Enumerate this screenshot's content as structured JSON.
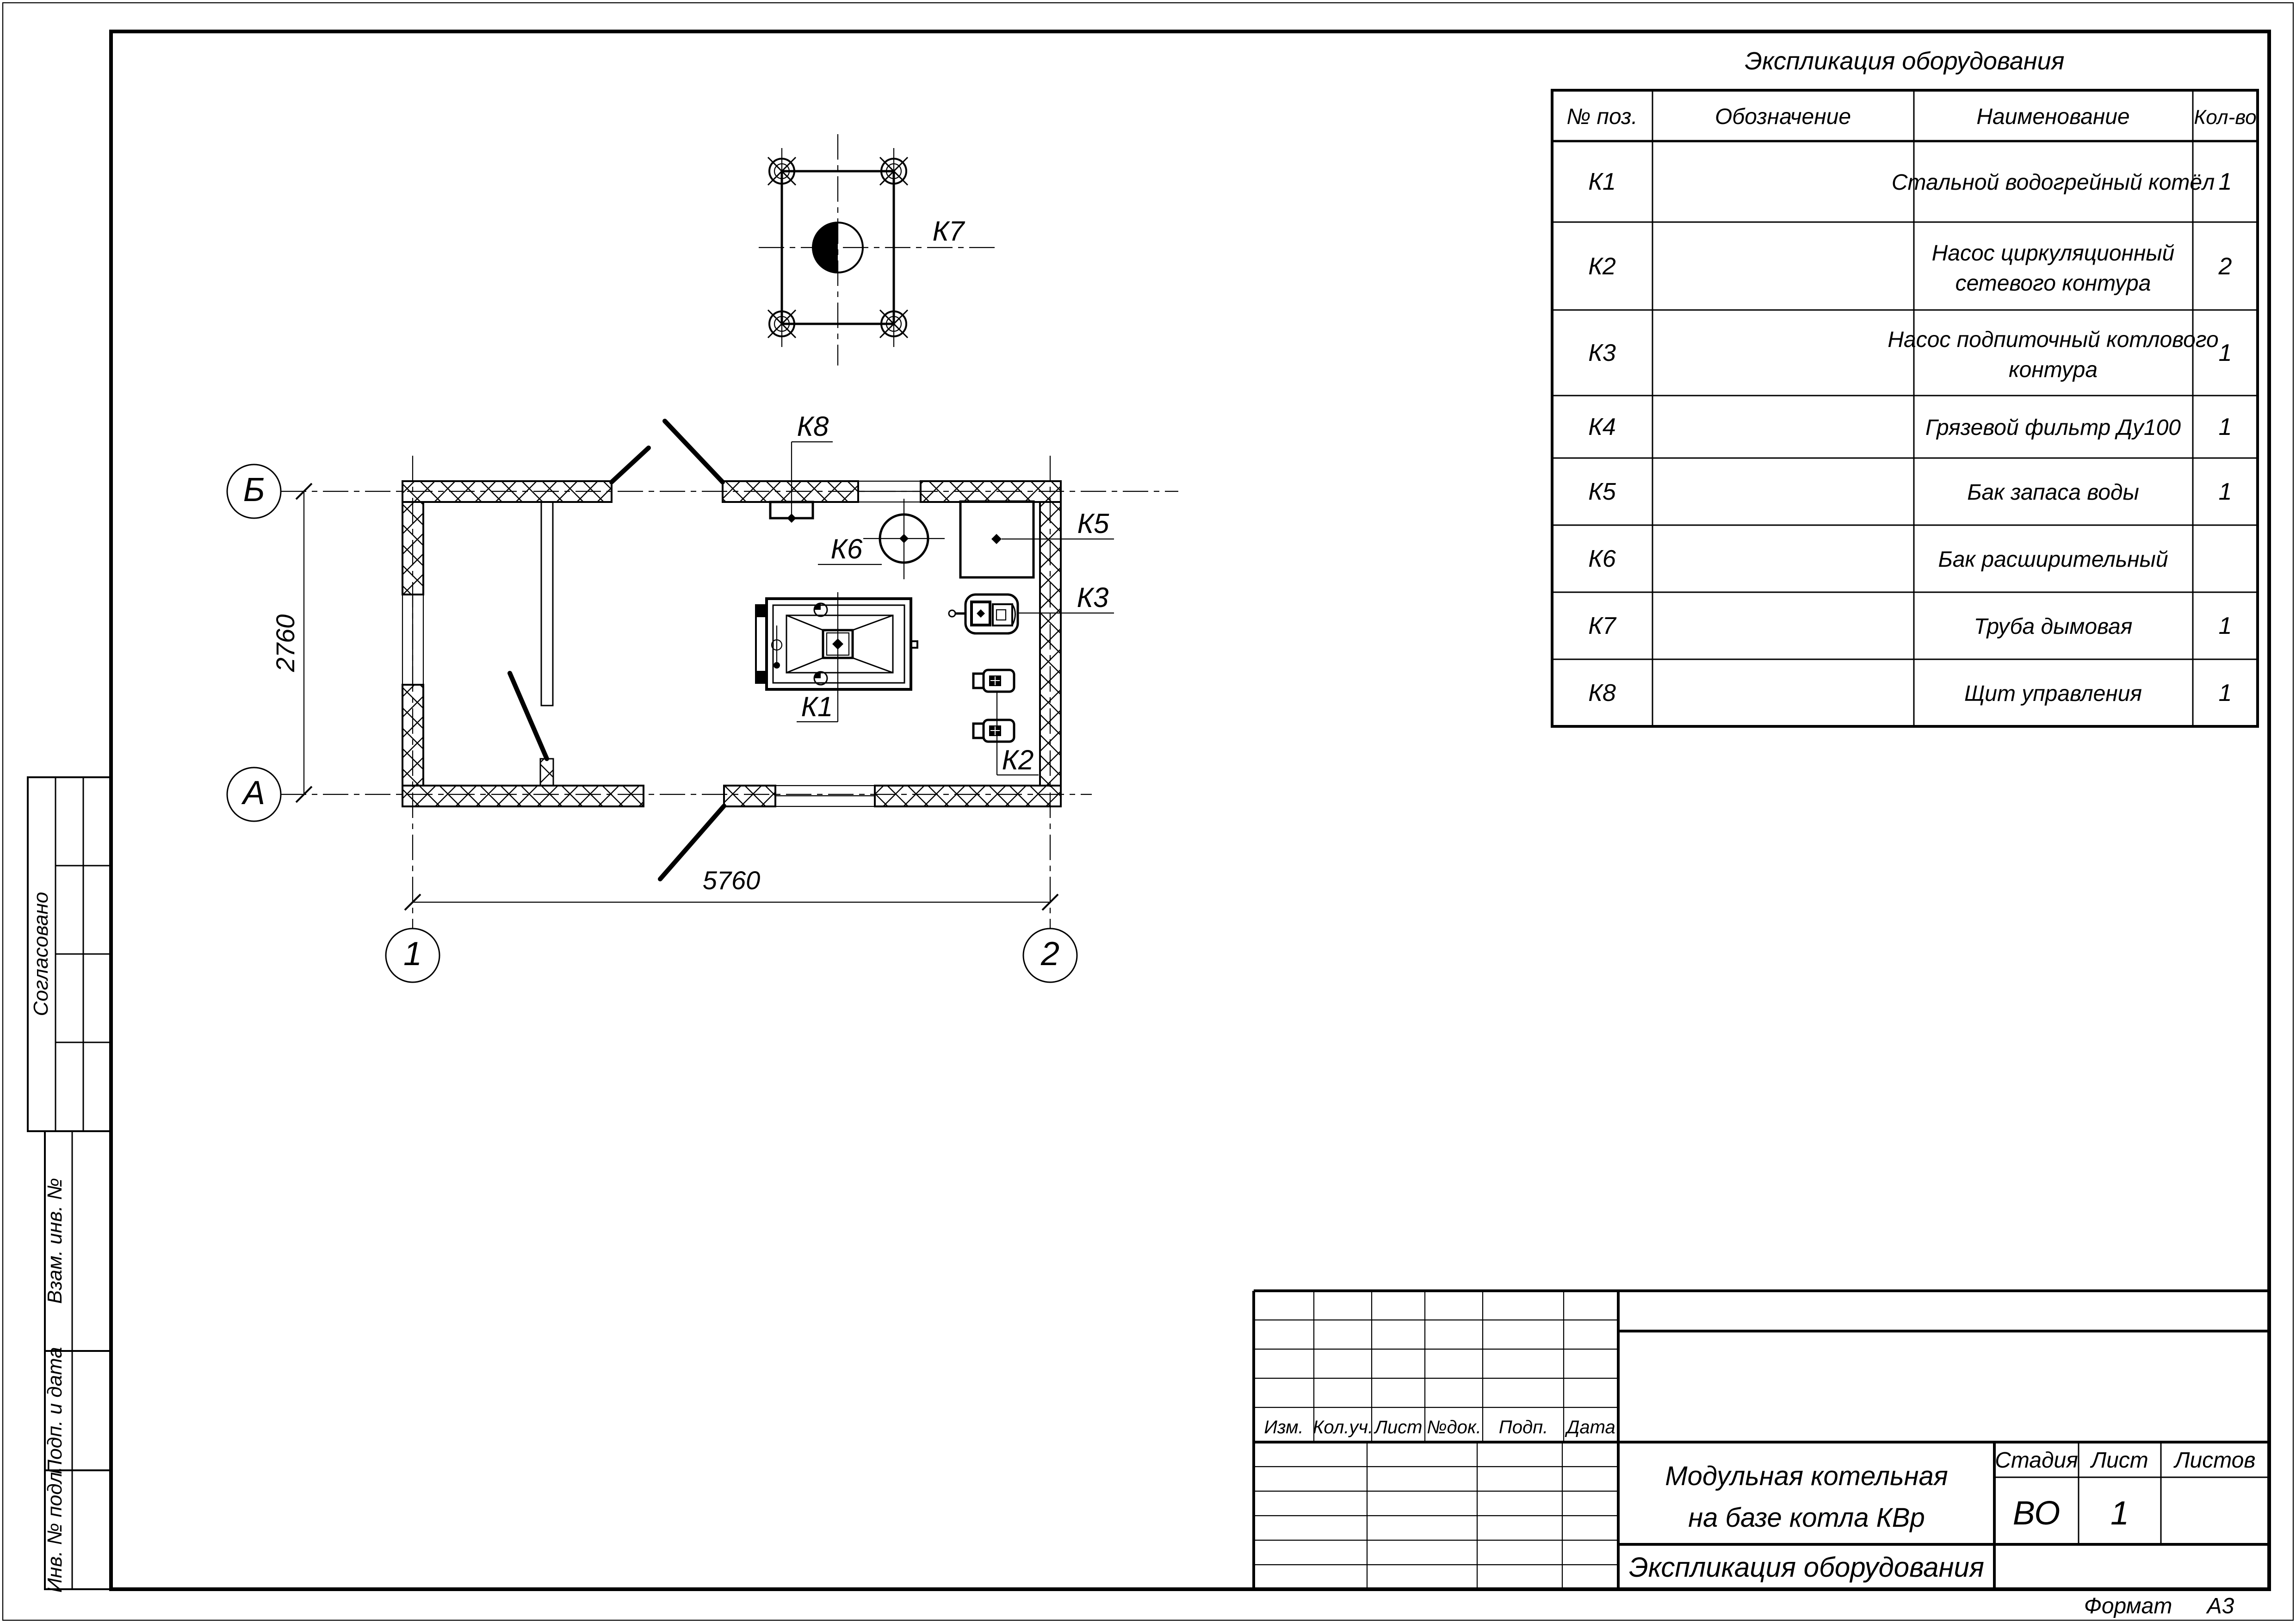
{
  "sheet": {
    "format_label": "Формат",
    "format_value": "А3"
  },
  "equipment_table": {
    "title": "Экспликация оборудования",
    "columns": [
      "№ поз.",
      "Обозначение",
      "Наименование",
      "Кол-во"
    ],
    "rows": [
      {
        "pos": "К1",
        "designation": "",
        "name": "Стальной водогрейный котёл",
        "name2": "",
        "qty": "1"
      },
      {
        "pos": "К2",
        "designation": "",
        "name": "Насос циркуляционный",
        "name2": "сетевого контура",
        "qty": "2"
      },
      {
        "pos": "К3",
        "designation": "",
        "name": "Насос подпиточный котлового",
        "name2": "контура",
        "qty": "1"
      },
      {
        "pos": "К4",
        "designation": "",
        "name": "Грязевой фильтр Ду100",
        "name2": "",
        "qty": "1"
      },
      {
        "pos": "К5",
        "designation": "",
        "name": "Бак запаса воды",
        "name2": "",
        "qty": "1"
      },
      {
        "pos": "К6",
        "designation": "",
        "name": "Бак расширительный",
        "name2": "",
        "qty": ""
      },
      {
        "pos": "К7",
        "designation": "",
        "name": "Труба дымовая",
        "name2": "",
        "qty": "1"
      },
      {
        "pos": "К8",
        "designation": "",
        "name": "Щит управления",
        "name2": "",
        "qty": "1"
      }
    ]
  },
  "plan": {
    "axes": {
      "row_top": "Б",
      "row_bottom": "А",
      "col_left": "1",
      "col_right": "2"
    },
    "dims": {
      "horizontal": "5760",
      "vertical": "2760"
    },
    "labels": {
      "k1": "К1",
      "k2": "К2",
      "k3": "К3",
      "k5": "К5",
      "k6": "К6",
      "k7": "К7",
      "k8": "К8"
    }
  },
  "title_block": {
    "revision_headers": [
      "Изм.",
      "Кол.уч.",
      "Лист",
      "№док.",
      "Подп.",
      "Дата"
    ],
    "project_title1": "Модульная котельная",
    "project_title2": "на базе котла КВр",
    "doc_title": "Экспликация оборудования",
    "stage_label": "Стадия",
    "list_label": "Лист",
    "lists_label": "Листов",
    "stage": "ВО",
    "list": "1",
    "lists": ""
  },
  "side_stamps": {
    "approved": "Согласовано",
    "vzam": "Взам. инв. №",
    "podp": "Подп. и дата",
    "inv": "Инв. № подл."
  }
}
